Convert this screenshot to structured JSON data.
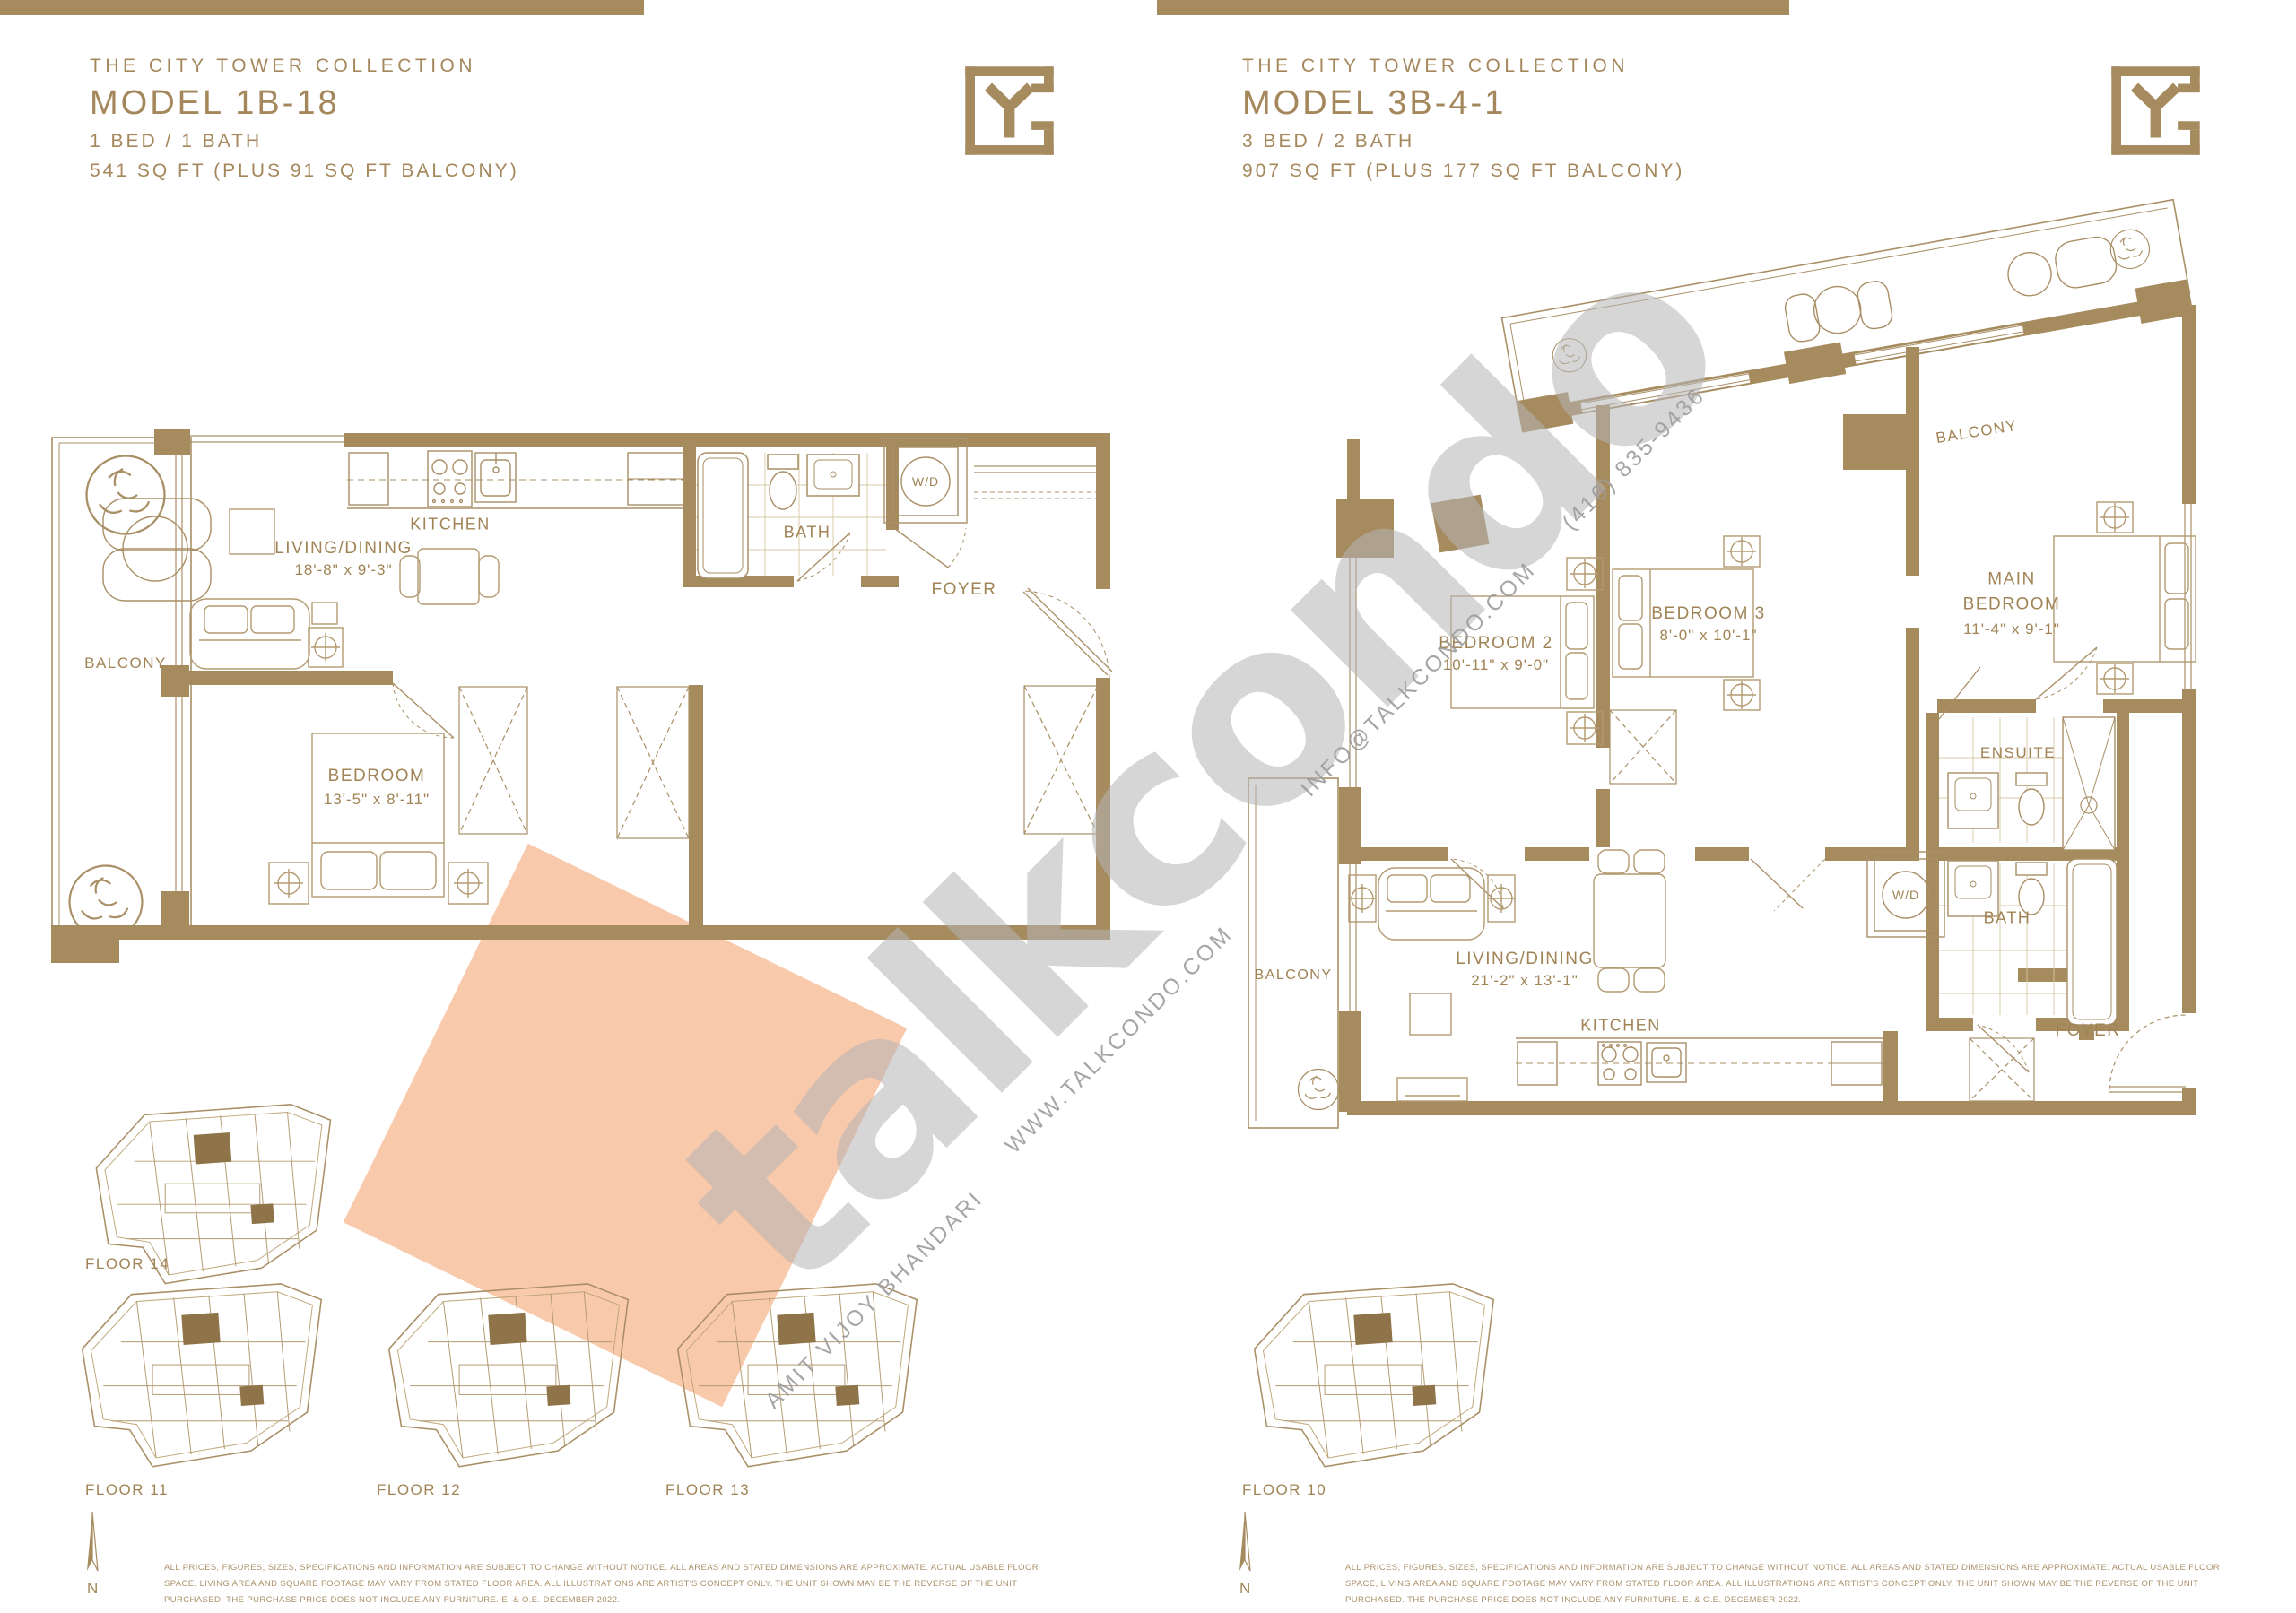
{
  "left_page": {
    "collection": "THE CITY TOWER COLLECTION",
    "model": "MODEL 1B-18",
    "config": "1 BED / 1 BATH",
    "area": "541 SQ FT (PLUS 91 SQ FT BALCONY)",
    "rooms": {
      "balcony": "BALCONY",
      "living": "LIVING/DINING",
      "living_dims": "18'-8\" x 9'-3\"",
      "kitchen": "KITCHEN",
      "bath": "BATH",
      "wd": "W/D",
      "foyer": "FOYER",
      "bedroom": "BEDROOM",
      "bedroom_dims": "13'-5\" x 8'-11\""
    },
    "floors": [
      "FLOOR 14",
      "FLOOR 11",
      "FLOOR 12",
      "FLOOR 13"
    ],
    "north": "N",
    "disclaimer": "ALL PRICES, FIGURES, SIZES, SPECIFICATIONS AND INFORMATION ARE SUBJECT TO CHANGE WITHOUT NOTICE. ALL AREAS AND STATED DIMENSIONS ARE APPROXIMATE. ACTUAL USABLE FLOOR SPACE, LIVING AREA AND SQUARE FOOTAGE MAY VARY FROM STATED FLOOR AREA. ALL ILLUSTRATIONS ARE ARTIST'S CONCEPT ONLY. THE UNIT SHOWN MAY BE THE REVERSE OF THE UNIT PURCHASED. THE PURCHASE PRICE DOES NOT INCLUDE ANY FURNITURE. E. & O.E. DECEMBER 2022."
  },
  "right_page": {
    "collection": "THE CITY TOWER COLLECTION",
    "model": "MODEL 3B-4-1",
    "config": "3 BED / 2 BATH",
    "area": "907 SQ FT (PLUS 177 SQ FT BALCONY)",
    "rooms": {
      "balcony_top": "BALCONY",
      "balcony_left": "BALCONY",
      "bedroom2": "BEDROOM 2",
      "bedroom2_dims": "10'-11\" x 9'-0\"",
      "bedroom3": "BEDROOM 3",
      "bedroom3_dims": "8'-0\" x 10'-1\"",
      "main_bedroom": "MAIN BEDROOM",
      "main_bedroom_dims": "11'-4\" x 9'-1\"",
      "ensuite": "ENSUITE",
      "bath": "BATH",
      "wd": "W/D",
      "living": "LIVING/DINING",
      "living_dims": "21'-2\" x 13'-1\"",
      "kitchen": "KITCHEN",
      "foyer": "FOYER"
    },
    "floors": [
      "FLOOR 10"
    ],
    "north": "N",
    "disclaimer": "ALL PRICES, FIGURES, SIZES, SPECIFICATIONS AND INFORMATION ARE SUBJECT TO CHANGE WITHOUT NOTICE. ALL AREAS AND STATED DIMENSIONS ARE APPROXIMATE. ACTUAL USABLE FLOOR SPACE, LIVING AREA AND SQUARE FOOTAGE MAY VARY FROM STATED FLOOR AREA. ALL ILLUSTRATIONS ARE ARTIST'S CONCEPT ONLY. THE UNIT SHOWN MAY BE THE REVERSE OF THE UNIT PURCHASED. THE PURCHASE PRICE DOES NOT INCLUDE ANY FURNITURE. E. & O.E. DECEMBER 2022."
  },
  "watermark": {
    "brand": "talkcondo",
    "email": "INFO@TALKCONDO.COM",
    "phone": "(416) 835-9436",
    "website": "WWW.TALKCONDO.COM",
    "agent": "AMIT VIJOY BHANDARI"
  }
}
